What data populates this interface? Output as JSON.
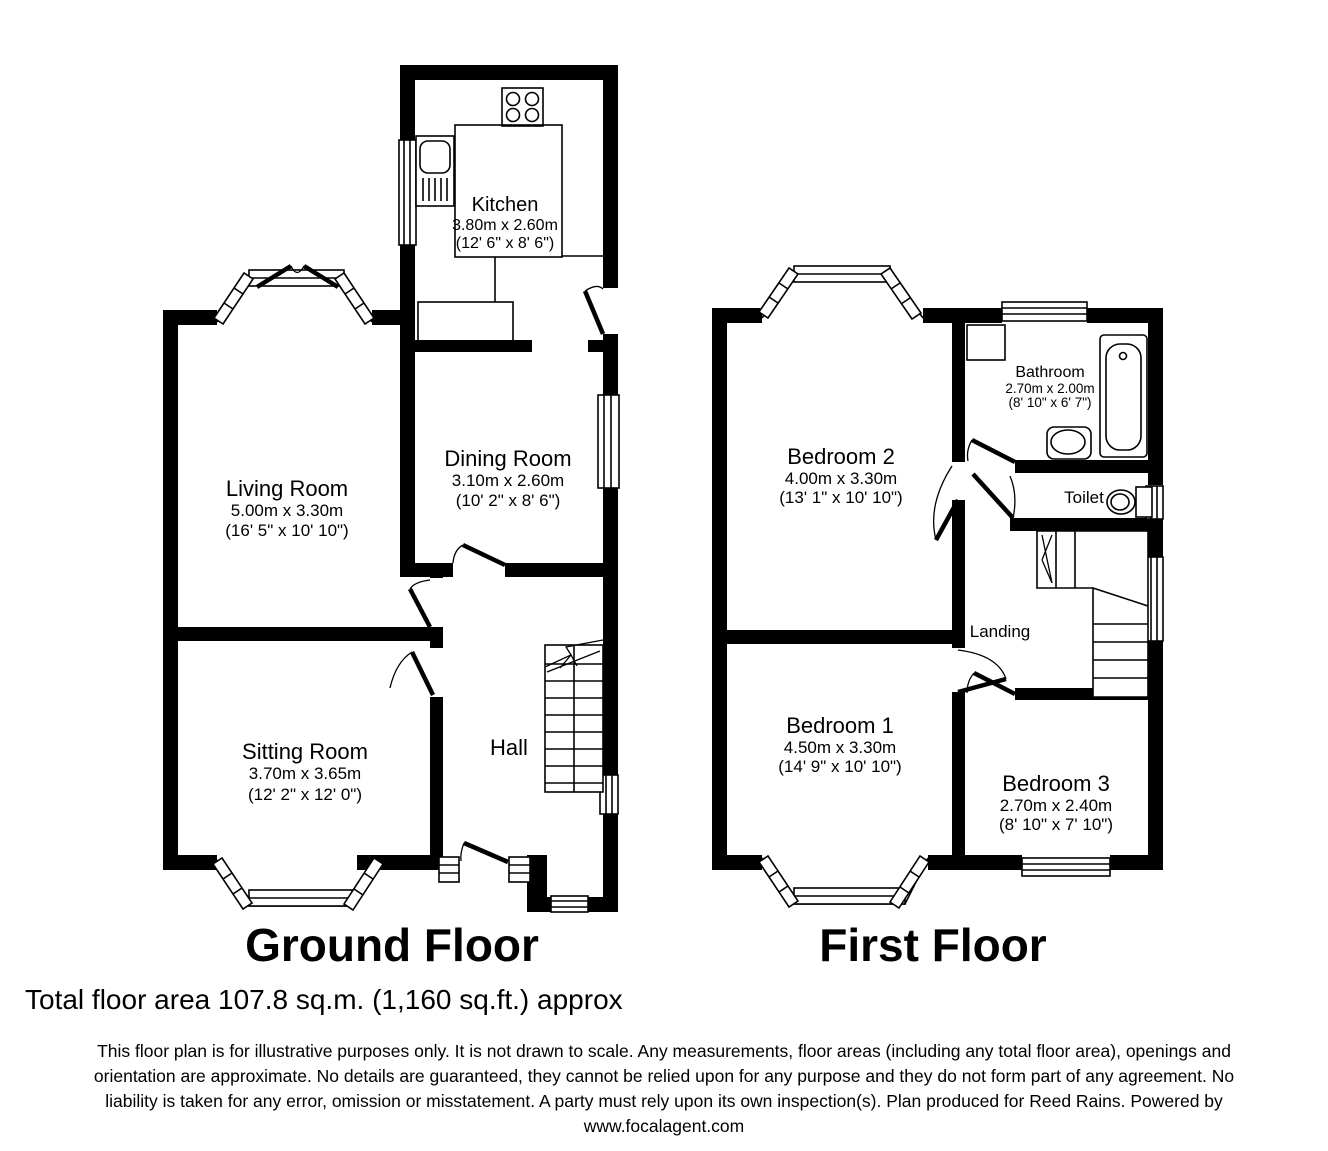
{
  "ground_floor": {
    "title": "Ground Floor",
    "rooms": {
      "kitchen": {
        "name": "Kitchen",
        "metric": "3.80m x 2.60m",
        "imperial": "(12' 6\" x 8' 6\")"
      },
      "living_room": {
        "name": "Living Room",
        "metric": "5.00m x 3.30m",
        "imperial": "(16' 5\" x 10' 10\")"
      },
      "dining_room": {
        "name": "Dining Room",
        "metric": "3.10m x 2.60m",
        "imperial": "(10' 2\" x 8' 6\")"
      },
      "sitting_room": {
        "name": "Sitting Room",
        "metric": "3.70m x 3.65m",
        "imperial": "(12' 2\" x 12' 0\")"
      },
      "hall": {
        "name": "Hall"
      }
    }
  },
  "first_floor": {
    "title": "First Floor",
    "rooms": {
      "bedroom2": {
        "name": "Bedroom 2",
        "metric": "4.00m x 3.30m",
        "imperial": "(13' 1\" x 10' 10\")"
      },
      "bathroom": {
        "name": "Bathroom",
        "metric": "2.70m x 2.00m",
        "imperial": "(8' 10\" x 6' 7\")"
      },
      "toilet": {
        "name": "Toilet"
      },
      "landing": {
        "name": "Landing"
      },
      "bedroom1": {
        "name": "Bedroom 1",
        "metric": "4.50m x 3.30m",
        "imperial": "(14' 9\" x 10' 10\")"
      },
      "bedroom3": {
        "name": "Bedroom 3",
        "metric": "2.70m x 2.40m",
        "imperial": "(8' 10\" x 7' 10\")"
      }
    }
  },
  "footer": {
    "total_area": "Total floor area 107.8 sq.m. (1,160 sq.ft.) approx",
    "disclaimer_lines": [
      "This floor plan is for illustrative purposes only. It is not drawn to scale. Any measurements, floor areas (including any total floor area), openings and",
      "orientation are approximate. No details are guaranteed, they cannot be relied upon for any purpose and they do not form part of any agreement. No",
      "liability is taken for any error, omission or misstatement. A party must rely upon its own inspection(s). Plan produced for Reed Rains. Powered by",
      "www.focalagent.com"
    ]
  },
  "colors": {
    "wall": "#000000",
    "background": "#ffffff"
  }
}
